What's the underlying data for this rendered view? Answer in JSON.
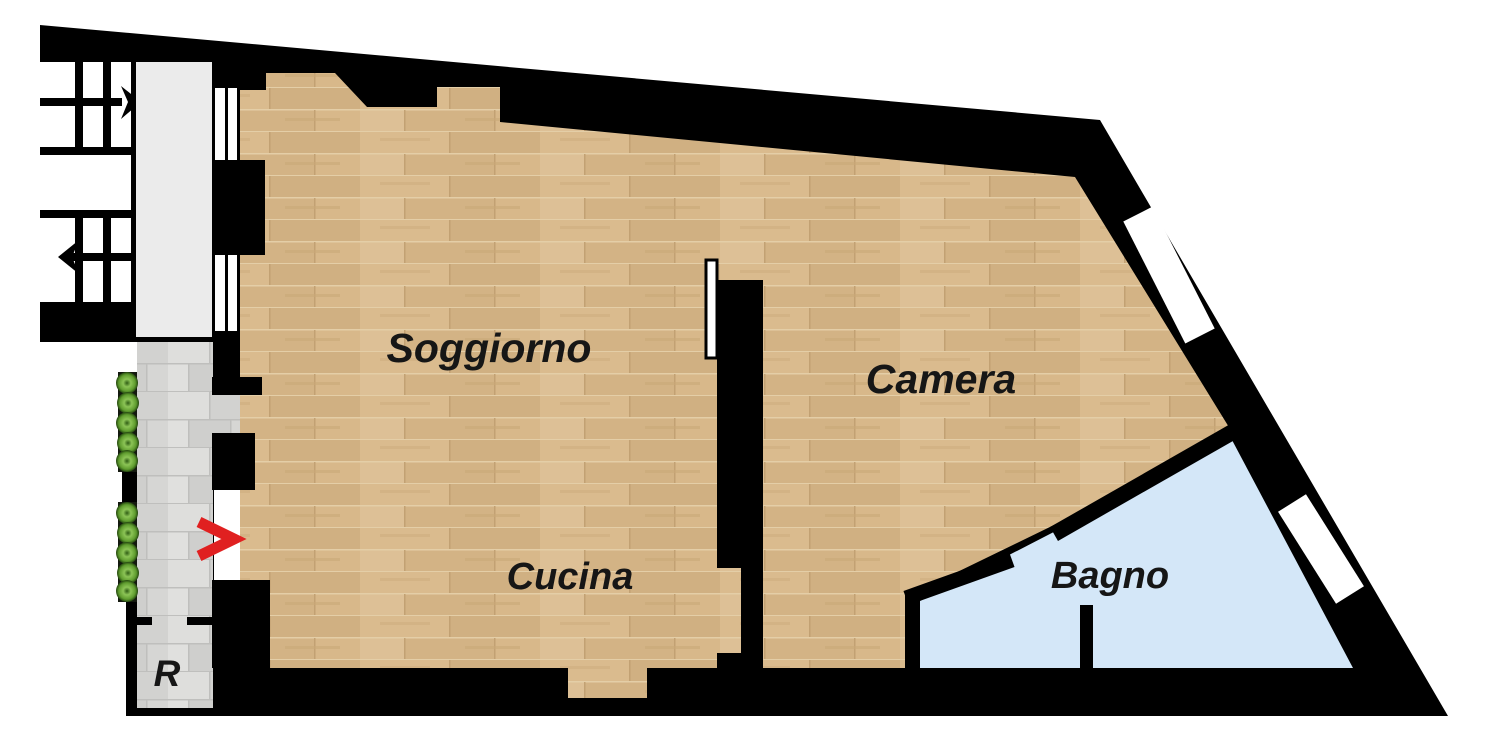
{
  "plan": {
    "rooms": {
      "soggiorno": {
        "label": "Soggiorno"
      },
      "cucina": {
        "label": "Cucina"
      },
      "camera": {
        "label": "Camera"
      },
      "bagno": {
        "label": "Bagno"
      },
      "storage": {
        "label": "R"
      }
    },
    "icons": {
      "entrance_arrow": "chevron-right",
      "stair_direction_top": "arrow-right",
      "stair_direction_bottom": "arrow-left",
      "plants": "shrub-row",
      "windows": "wall-window-gap"
    },
    "colors": {
      "wall": "#000000",
      "wood_floor_base": "#d6b78b",
      "stone_floor_base": "#d9d9d7",
      "bathroom_floor": "#d4e7f8",
      "landing_floor": "#ebebeb",
      "entrance_arrow": "#e02020",
      "plant_green": "#6fae3a",
      "label_text": "#161616"
    }
  }
}
